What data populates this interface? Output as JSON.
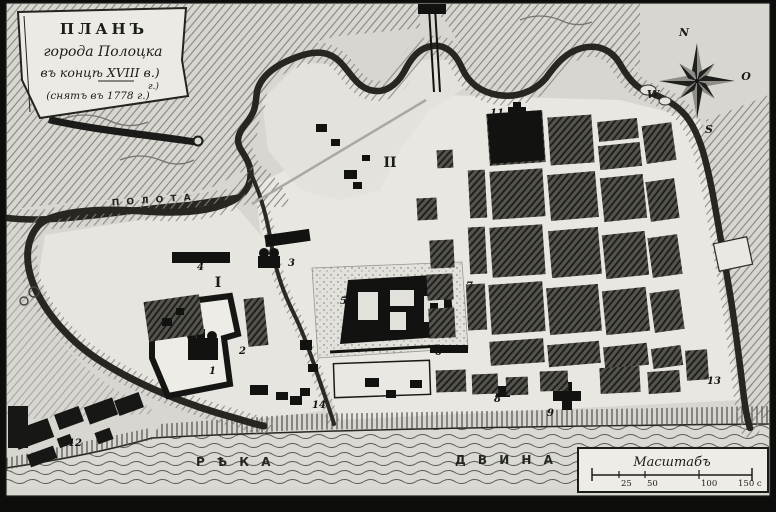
{
  "cartouche": {
    "line1": "ПЛАНЪ",
    "line2": "города Полоцка",
    "line3": "въ концѣ XVIII в.)",
    "line3b": "г.)",
    "line4": "(снятъ въ 1778 г.)"
  },
  "compass": {
    "n": "N",
    "e": "O",
    "s": "S",
    "w": "W"
  },
  "labels": {
    "polota": "П О Л О Т А",
    "dvina1": "Р Ѣ К А",
    "dvina2": "Д В И Н А",
    "district1": "I",
    "district2": "II"
  },
  "scale": {
    "title": "Масштабъ",
    "t25": "25",
    "t50": "50",
    "t100": "100",
    "t150": "150 с"
  },
  "markers": {
    "m1": "1",
    "m2": "2",
    "m3": "3",
    "m4": "4",
    "m5": "5",
    "m6": "6",
    "m7": "7",
    "m8": "8",
    "m9": "9",
    "m11": "11",
    "m12": "12",
    "m13": "13",
    "m14": "14"
  },
  "colors": {
    "paper": "#d7d6d0",
    "ink": "#1c1c1a",
    "water_line": "#5d5b55"
  }
}
